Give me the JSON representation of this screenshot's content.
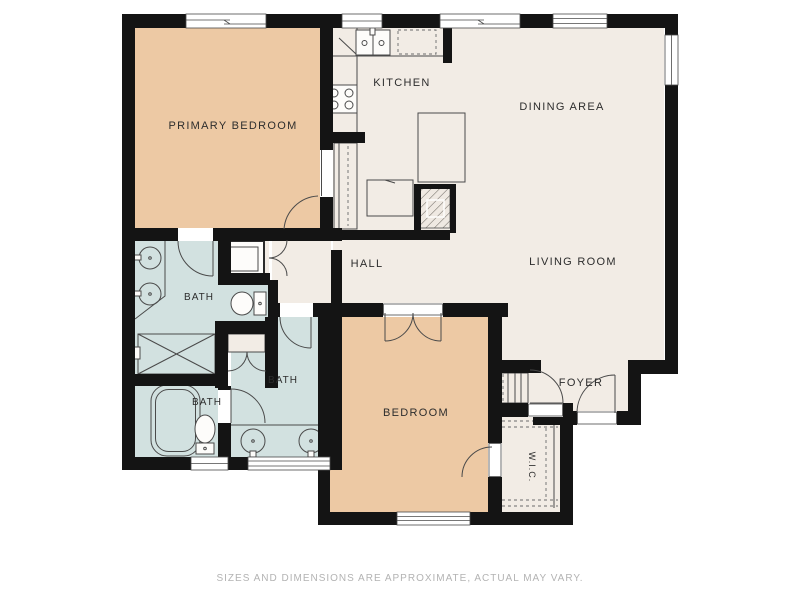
{
  "colors": {
    "floor_cream": "#f2ece5",
    "bedroom_peach": "#edc9a4",
    "bath_blue": "#d2e1e0",
    "wall_black": "#141414",
    "fixture_stroke": "#4a4a4a",
    "label_text": "#2d2d2d",
    "footer_text": "#b3b3b3"
  },
  "rooms": {
    "primary_bedroom": {
      "label": "PRIMARY BEDROOM"
    },
    "kitchen": {
      "label": "KITCHEN"
    },
    "dining_area": {
      "label": "DINING AREA"
    },
    "living_room": {
      "label": "LIVING ROOM"
    },
    "hall": {
      "label": "HALL"
    },
    "bath_primary": {
      "label": "BATH"
    },
    "bath_middle": {
      "label": "BATH"
    },
    "bath_small": {
      "label": "BATH"
    },
    "bedroom": {
      "label": "BEDROOM"
    },
    "foyer": {
      "label": "FOYER"
    },
    "wic": {
      "label": "W.I.C."
    }
  },
  "footer": {
    "disclaimer": "SIZES AND DIMENSIONS ARE APPROXIMATE, ACTUAL MAY VARY."
  }
}
